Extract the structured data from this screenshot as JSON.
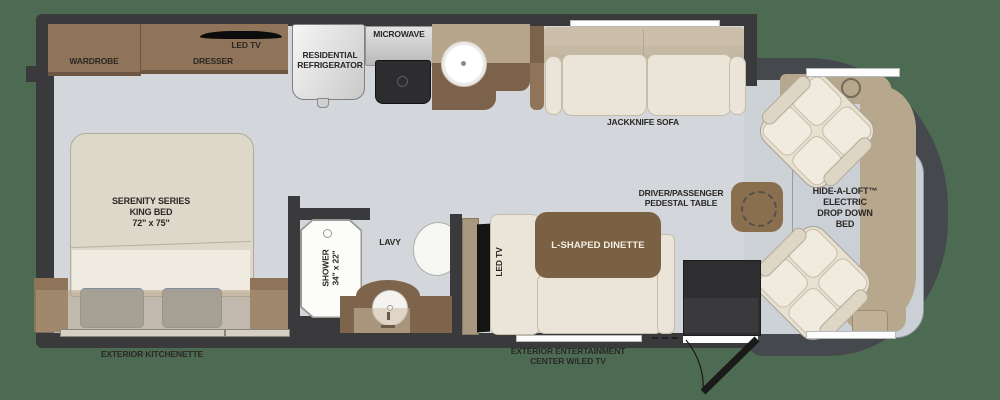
{
  "plan_title": "Class A motorhome floor plan",
  "colors": {
    "exterior_background": "#4d6b53",
    "wall": "#3a3a3c",
    "interior_floor": "#d3d6da",
    "cabinet_brown": "#8f7459",
    "counter_light": "#b6a58b",
    "counter_dark": "#7c624a",
    "dinette_table": "#7b6144",
    "upholstery_cream": "#eae5d8",
    "upholstery_back": "#cbbfaa",
    "front_cap": "#45484d",
    "dashboard_tan": "#b7a78c",
    "slide_overlay": "rgba(176,156,128,0.5)"
  },
  "labels": {
    "wardrobe": "WARDROBE",
    "dresser": "DRESSER",
    "bedroom_tv": "LED TV",
    "bed": [
      "SERENITY SERIES",
      "KING BED",
      "72\" x 75\""
    ],
    "refrigerator": [
      "RESIDENTIAL",
      "REFRIGERATOR"
    ],
    "microwave": "MICROWAVE",
    "sofa": "JACKKNIFE SOFA",
    "shower": [
      "SHOWER",
      "34\" x 22\""
    ],
    "lavy": "LAVY",
    "dinette_tv": "LED TV",
    "dinette": "L-SHAPED DINETTE",
    "pedestal_table": [
      "DRIVER/PASSENGER",
      "PEDESTAL TABLE"
    ],
    "loft_bed": [
      "HIDE-A-LOFT™",
      "ELECTRIC",
      "DROP DOWN",
      "BED"
    ],
    "exterior_kitchenette": "EXTERIOR KITCHENETTE",
    "exterior_entertainment": [
      "EXTERIOR ENTERTAINMENT",
      "CENTER W/LED TV"
    ]
  }
}
